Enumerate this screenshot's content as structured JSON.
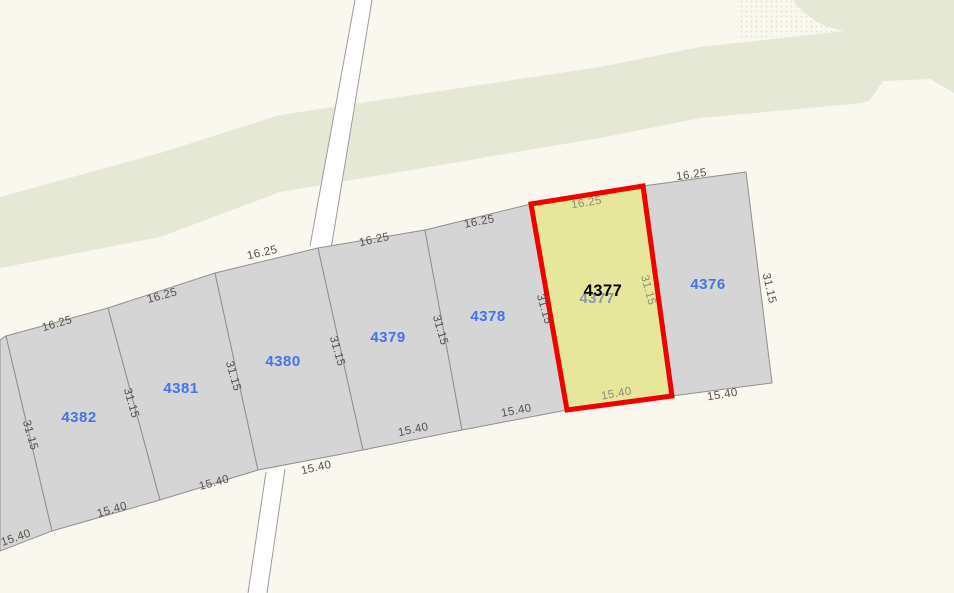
{
  "map": {
    "kind": "cadastral-parcel-map",
    "selected_parcel_id": "4377"
  },
  "dimensions": {
    "front_m": "16.25",
    "depth_m": "31.15",
    "rear_m": "15.40"
  },
  "parcels": {
    "list": [
      {
        "id": "4382"
      },
      {
        "id": "4381"
      },
      {
        "id": "4380"
      },
      {
        "id": "4379"
      },
      {
        "id": "4378"
      },
      {
        "id": "4377"
      },
      {
        "id": "4376"
      }
    ],
    "selected": {
      "id": "4377"
    }
  },
  "colors": {
    "background": "#FAF7EE",
    "greenway": "#E4E8D4",
    "parcel_fill": "#D5D5D5",
    "parcel_outline": "#8F8F8F",
    "road_fill": "#FFFFFF",
    "road_outline": "#9C9C9C",
    "selected_fill": "#E7E79B",
    "selected_outline": "#F20000",
    "parcel_label": "#4273E8",
    "selected_label": "#000000",
    "occluded_label": "#8C96AC",
    "dimension_label": "#55504A"
  }
}
